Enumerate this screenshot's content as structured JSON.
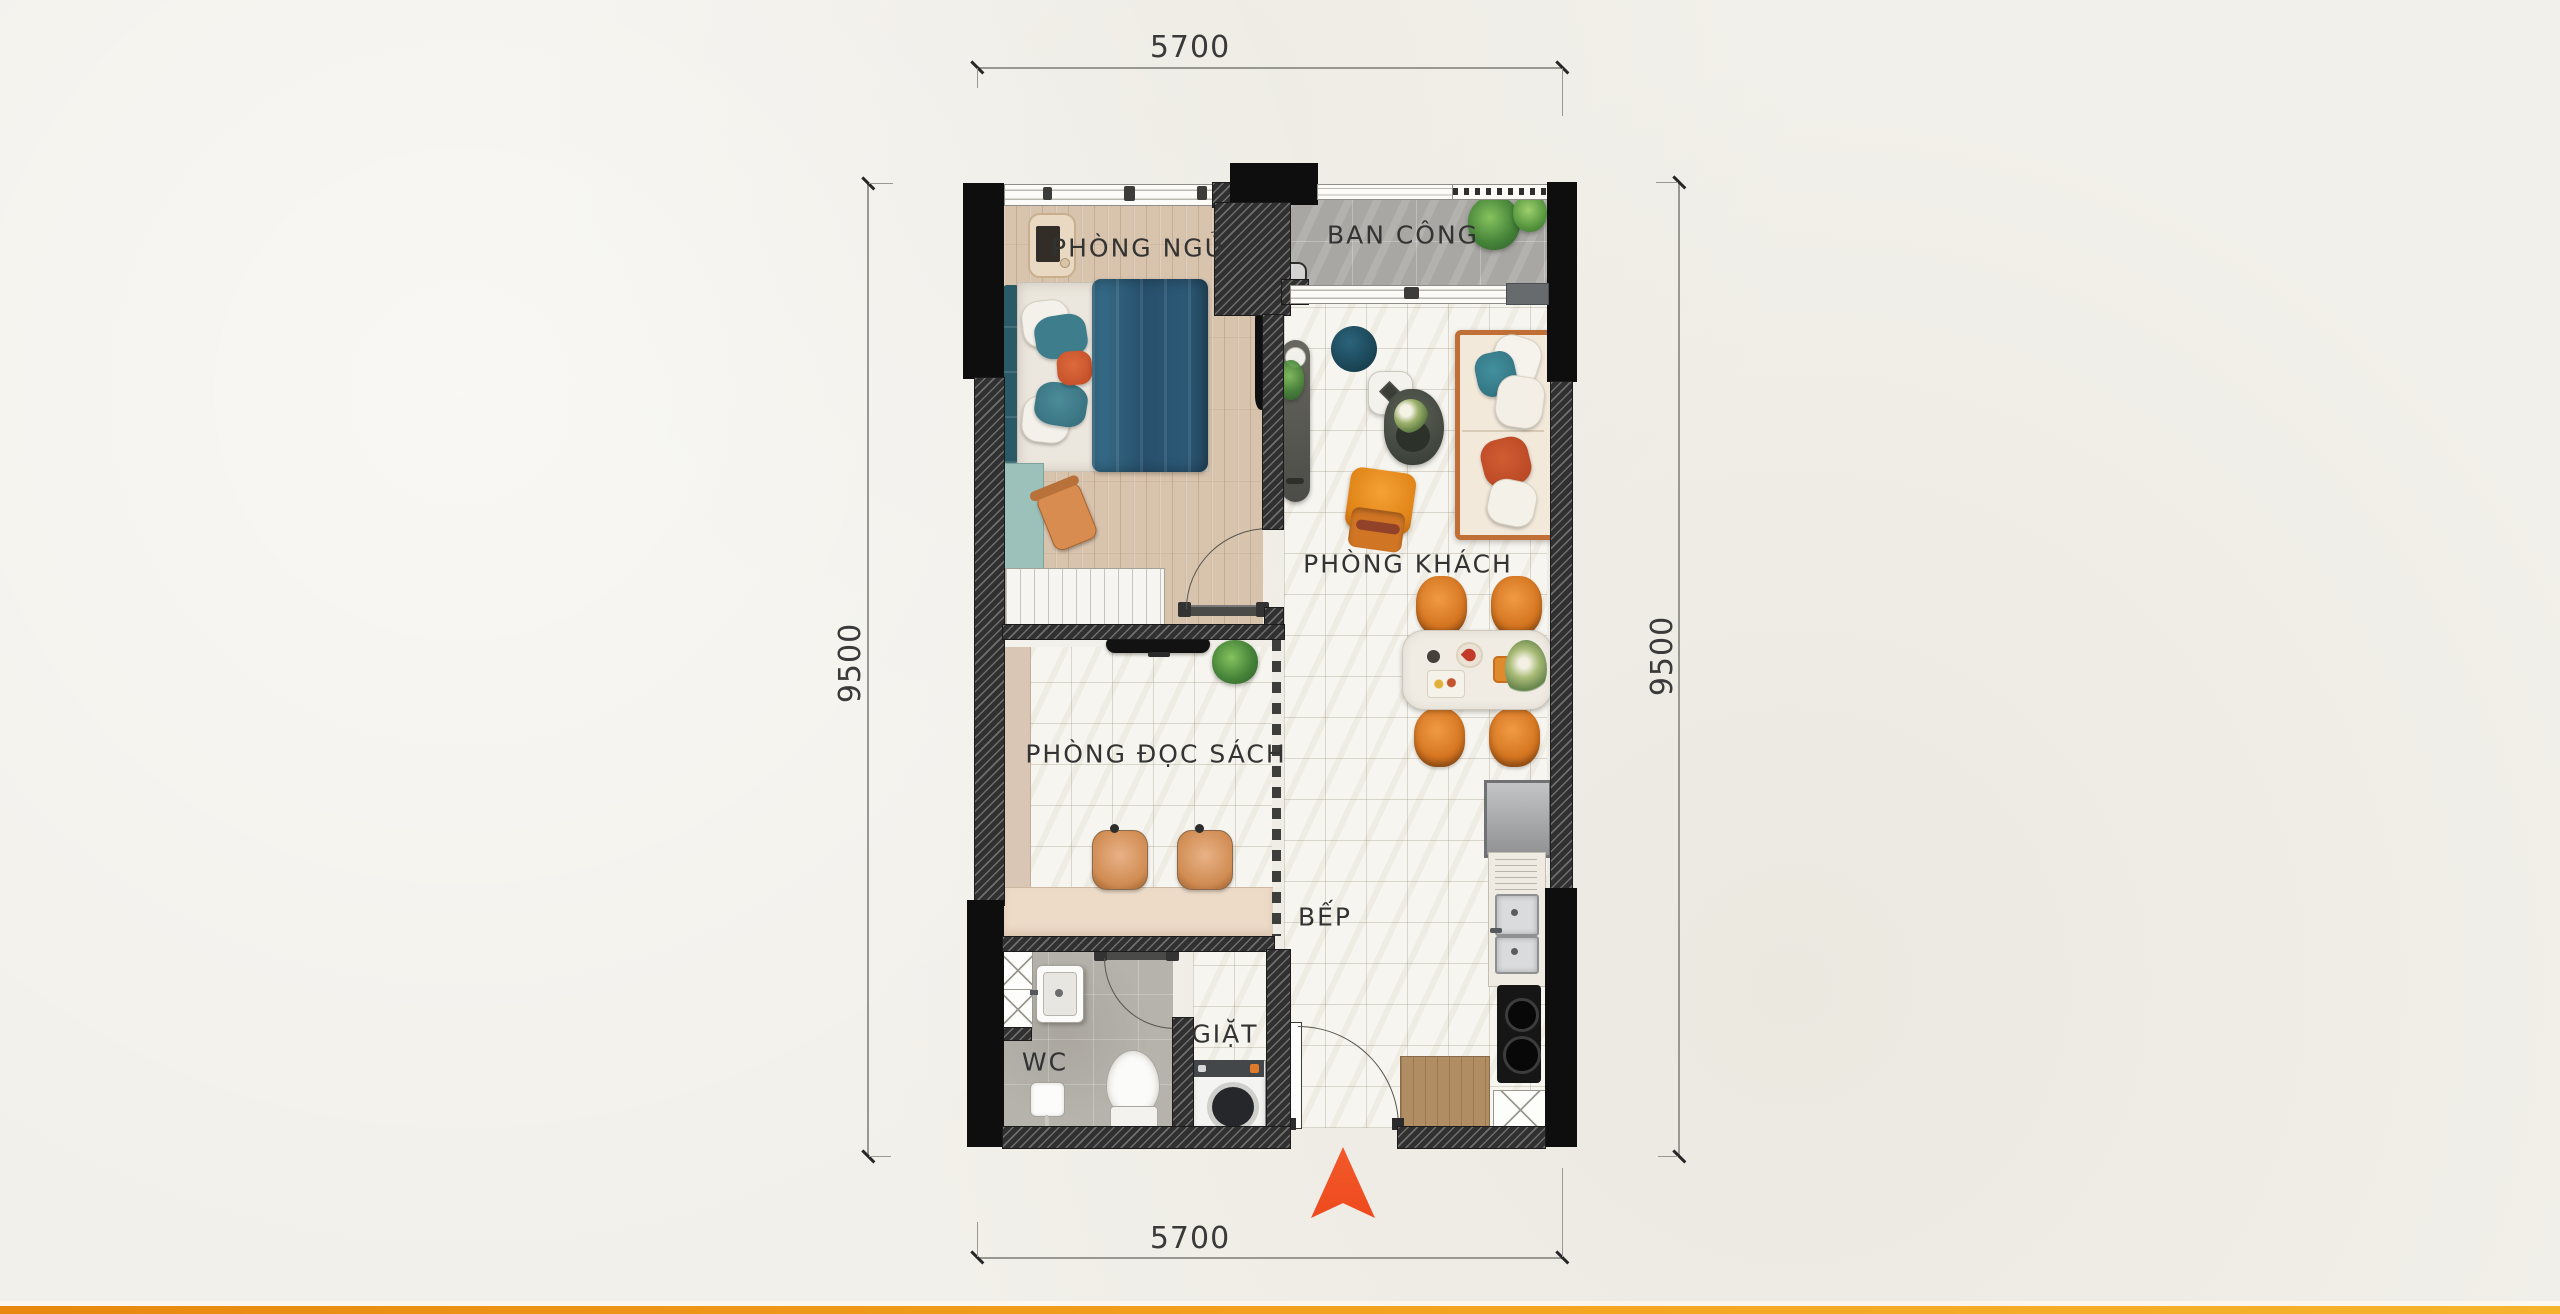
{
  "page": {
    "background_color": "#f2f0ea",
    "bottom_bar": {
      "left_color": "#e8880e",
      "right_color": "#f6b32c"
    }
  },
  "floorplan": {
    "dimensions": {
      "top": "5700",
      "bottom": "5700",
      "left": "9500",
      "right": "9500"
    },
    "rooms": {
      "bedroom": {
        "label": "PHÒNG NGỦ"
      },
      "balcony": {
        "label": "BAN CÔNG"
      },
      "living_room": {
        "label": "PHÒNG KHÁCH"
      },
      "reading_room": {
        "label": "PHÒNG ĐỌC SÁCH"
      },
      "kitchen": {
        "label": "BẾP"
      },
      "wc": {
        "label": "WC"
      },
      "laundry": {
        "label": "GIẶT"
      }
    },
    "colors": {
      "wall": "#0e0e0e",
      "wood_floor": "#d8c3ad",
      "balcony_tile": "#a8a7a3",
      "bed_blue": "#2c5876",
      "teal_accent": "#3e7d8c",
      "orange_accent": "#d4741f",
      "north_arrow": "#f24e22"
    }
  }
}
